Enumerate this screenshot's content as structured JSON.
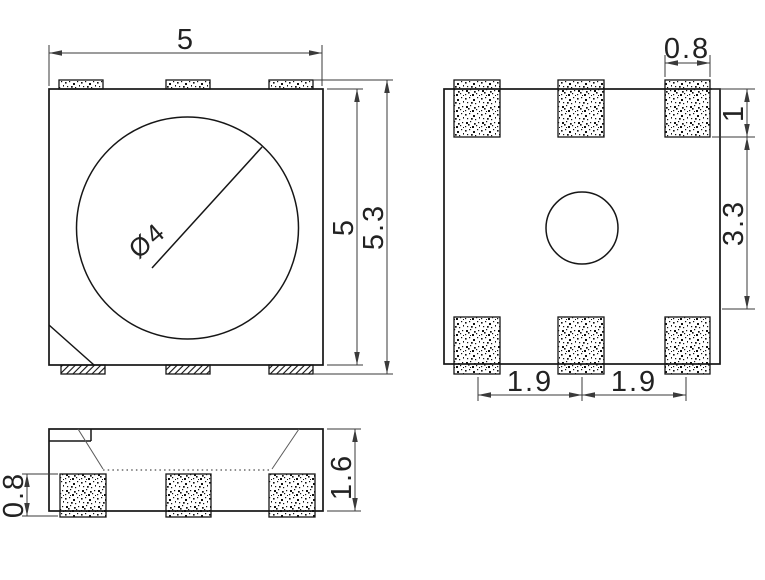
{
  "views": {
    "front": {
      "width": "5",
      "height": "5",
      "overall_height": "5.3",
      "lens_diameter": "Ø4"
    },
    "bottom": {
      "pad_width": "0.8",
      "pad_height": "1",
      "pad_gap": "3.3",
      "pitch_left": "1.9",
      "pitch_right": "1.9"
    },
    "side": {
      "pad_thickness": "0.8",
      "height": "1.6"
    }
  },
  "colors": {
    "outline": "#161616",
    "dimension": "#3a3a3a",
    "background": "#ffffff"
  }
}
